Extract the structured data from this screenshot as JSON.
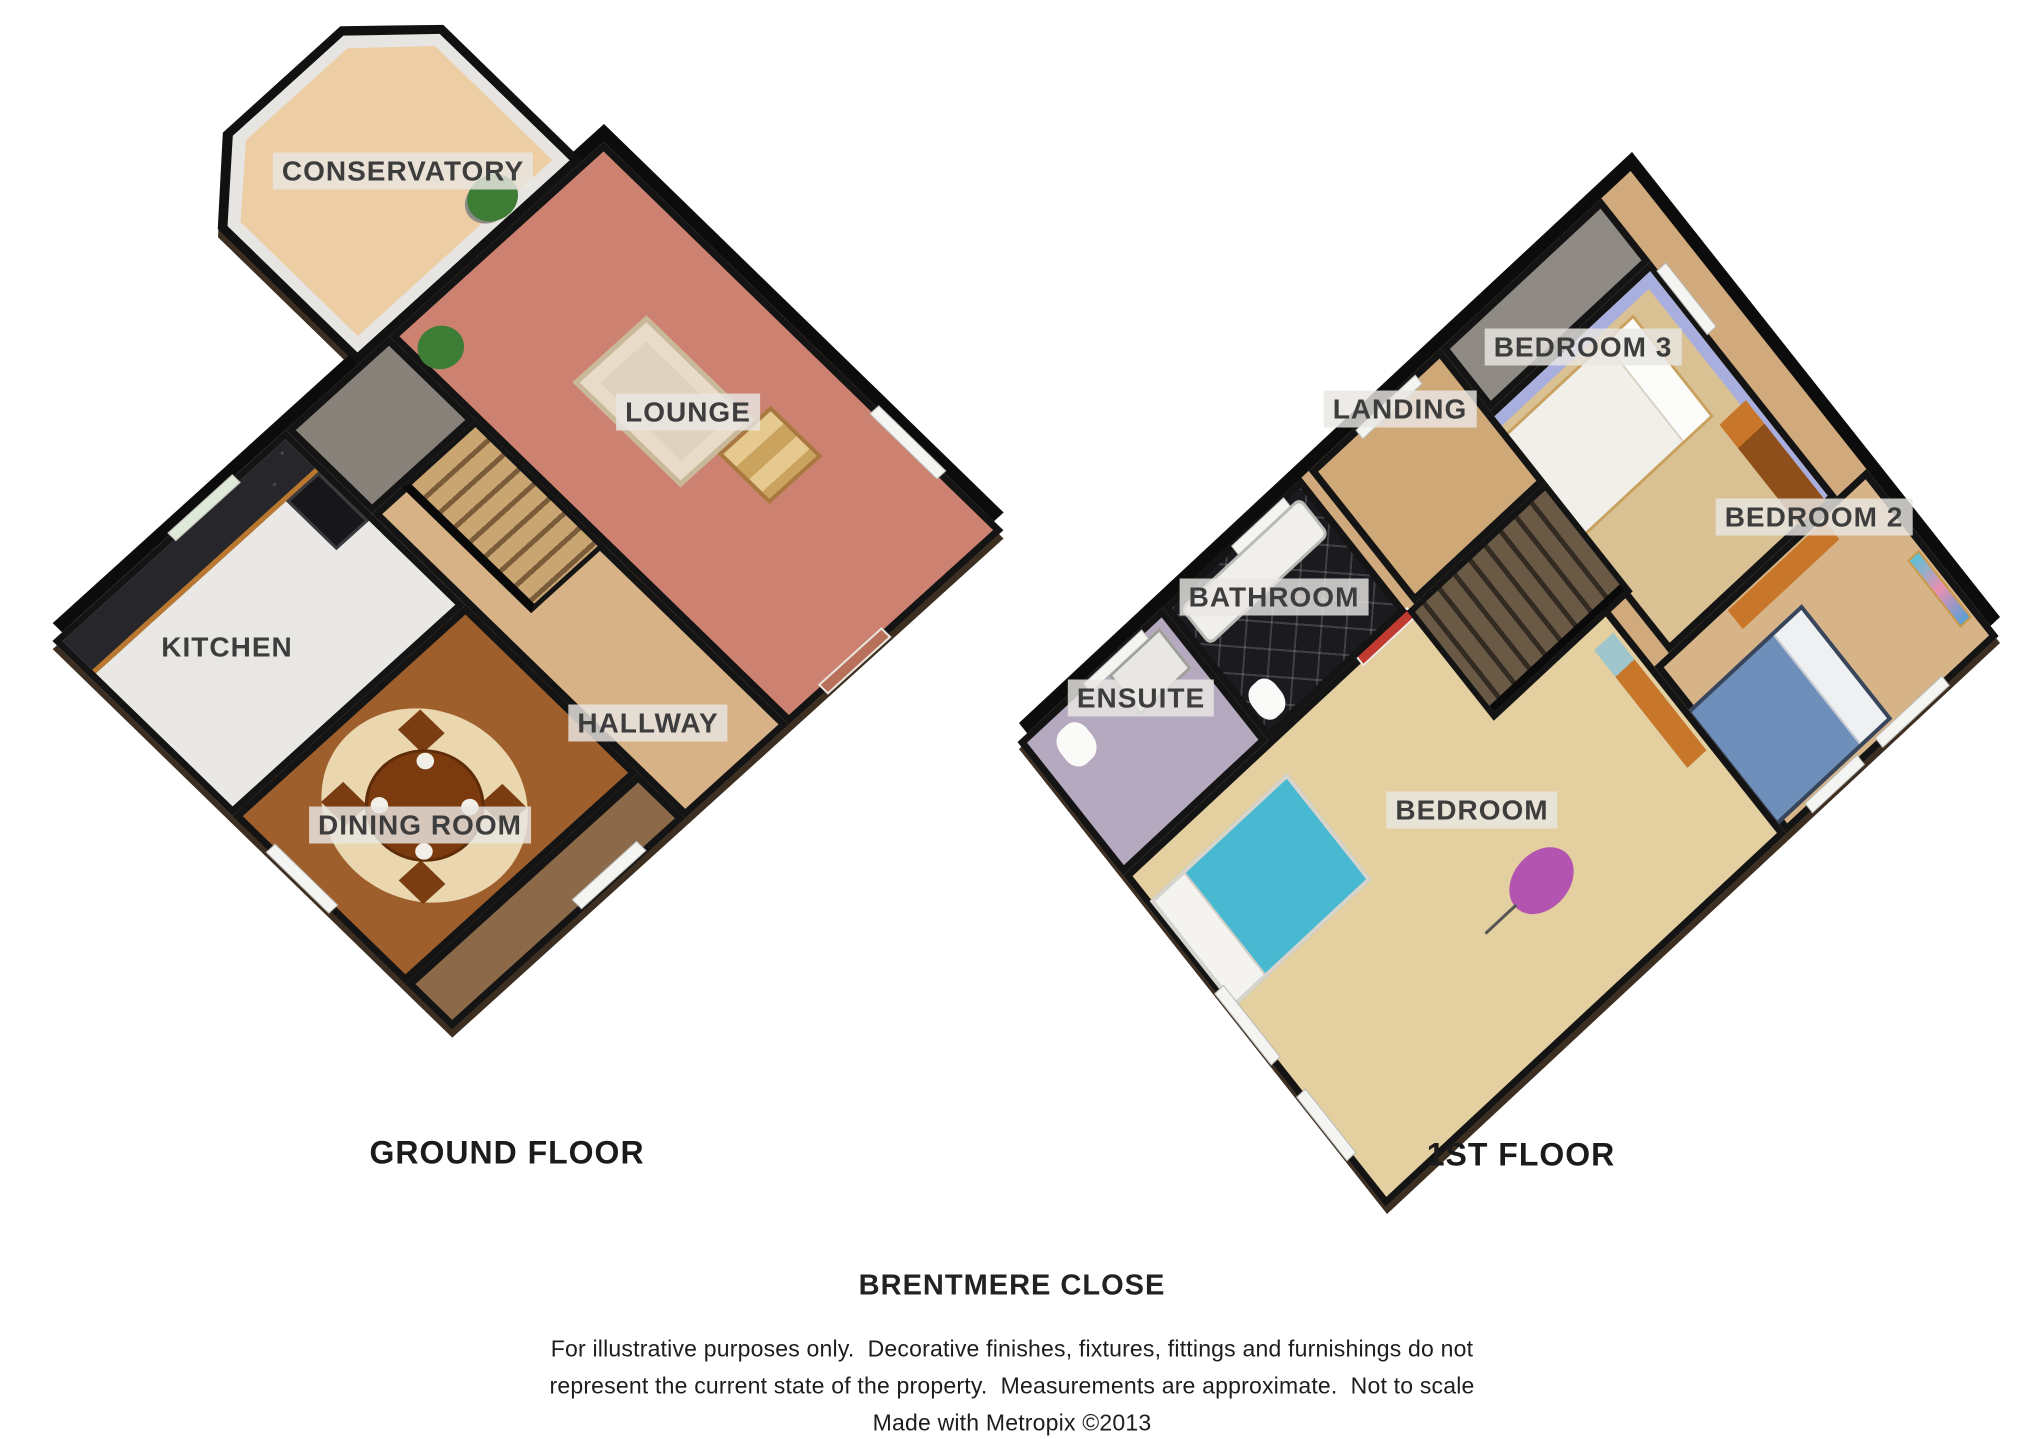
{
  "plans": {
    "ground": {
      "caption": "GROUND FLOOR",
      "rooms": {
        "conservatory": "CONSERVATORY",
        "lounge": "LOUNGE",
        "kitchen": "KITCHEN",
        "hallway": "HALLWAY",
        "dining": "DINING ROOM"
      }
    },
    "first": {
      "caption": "1ST FLOOR",
      "rooms": {
        "landing": "LANDING",
        "bedroom3": "BEDROOM 3",
        "bedroom2": "BEDROOM 2",
        "bathroom": "BATHROOM",
        "ensuite": "ENSUITE",
        "bedroom": "BEDROOM"
      }
    }
  },
  "footer": {
    "address": "BRENTMERE CLOSE",
    "disclaimer": [
      "For illustrative purposes only.  Decorative finishes, fixtures, fittings and furnishings do not",
      "represent the current state of the property.  Measurements are approximate.  Not to scale",
      "Made with Metropix ©2013"
    ]
  },
  "colors": {
    "wall": "#0c0c0c",
    "fascia": "#3d2e22",
    "lounge_carpet": "#cd8170",
    "conservatory_floor": "#edcda3",
    "kitchen_floor": "#eae8e4",
    "counter_granite": "#26262b",
    "dining_wood": "#9e5f2c",
    "hall_tan": "#d7b287",
    "bathroom_tile": "#1b1b1f",
    "ensuite_floor": "#b5a9bf",
    "master_floor": "#e3cf9f",
    "bedroom3_floor": "#d9c193",
    "bedroom2_floor": "#d6b488",
    "bed_blue": "#6d8fba",
    "bed_teal": "#49b9d2",
    "lamp_magenta": "#b355b0",
    "label_bg": "#e9e7e3",
    "label_text": "#3d3d3d"
  }
}
